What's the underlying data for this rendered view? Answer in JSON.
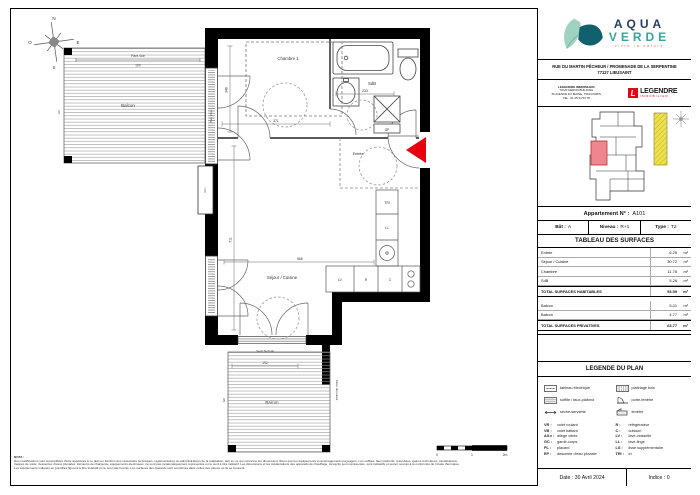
{
  "compass": {
    "n": "N",
    "s": "S",
    "e": "E",
    "o": "O"
  },
  "plan": {
    "arrow_color": "#e8000d",
    "rooms": {
      "chambre": "Chambre 1",
      "sdb": "SdB",
      "sejour": "Séjour / Cuisine",
      "entree": "Entrée",
      "balcon_haut": "Balcon",
      "balcon_bas": "Balcon"
    },
    "labels": {
      "pare_vue": "Pare-vue",
      "baie_vitree": "Baie vitrée",
      "allege": "All.v",
      "seuil": "Seuil Technal",
      "store": "Store déroulant",
      "gc_top": "GC",
      "gc_bottom": "GC",
      "gaine": "GP"
    },
    "kitchen": {
      "tri": "TRI",
      "ll": "LL",
      "lv": "LV",
      "r": "R",
      "c": "C"
    },
    "dims": {
      "d190": "190",
      "d348": "348",
      "d371": "371",
      "d233": "233",
      "d711": "711",
      "d566": "566",
      "d192": "192"
    }
  },
  "scalebar": {
    "t0": "0",
    "t1": "1",
    "t2": "2m"
  },
  "nota": {
    "title": "NOTA :",
    "line1": "Des modifications sont susceptibles d'être apportées à ce plan en fonction des nécessités techniques, réglementaires ou administratives de la réalisation, tant en ce qui concerne les dimensions libres que les équipements et aménagements paysagers. Les soffites, faux plafonds, retombées, gaines techniques, canalisations,",
    "line2": "trappes de visite, descentes d'eaux pluviales, éléments de charpente, équipements électriques, ne sont pas systématiquement représentés ou le sont à titre indicatif. Les dimensions et les implantations des appareils de chauffage, lorsqu'ils sont représentés, sont indicatifs et seront soumis à la conformité de l'étude thermique.",
    "line3": "Les équipements indiqués en pointillés figurent à titre indicatif et ne sont pas fournis. Les surfaces des placards sont comprises dans celles des pièces où ils se trouvent."
  },
  "titleblock": {
    "logo": {
      "word1": "AQUA",
      "word2": "VERDE",
      "tagline": "vivre la nature"
    },
    "address_line1": "RUE DU MARTIN PÊCHEUR / PROMENADE DE LA SERPENTINE",
    "address_line2": "77127 LIEUSAINT",
    "promoter": {
      "name": "LEGENDRE IMMOBILIER",
      "building": "TOUR HERON BUILDING",
      "street": "66 AVENUE DU MAINE, 75014 PARIS",
      "tel": "TEL : 01 45 54 53 78",
      "mark": "L",
      "brand": "LEGENDRE",
      "brand_sub": "IMMOBILIER",
      "brand_red": "#e30613"
    },
    "apartment": {
      "label": "Appartement N° :",
      "value": "A101"
    },
    "cells": {
      "bat_label": "Bât :",
      "bat": "A",
      "niveau_label": "Niveau :",
      "niveau": "R+1",
      "type_label": "Type :",
      "type": "T2"
    },
    "surfaces": {
      "title": "TABLEAU DES SURFACES",
      "unit": "m²",
      "rows": [
        {
          "label": "Entrée",
          "value": "6.25"
        },
        {
          "label": "Séjour / Cuisine",
          "value": "30.72"
        },
        {
          "label": "Chambre",
          "value": "11.76"
        },
        {
          "label": "SdB",
          "value": "5.26"
        }
      ],
      "total_hab": {
        "label": "TOTAL SURFACES HABITABLES",
        "value": "53.99"
      },
      "balcons": [
        {
          "label": "Balcon",
          "value": "5.01"
        },
        {
          "label": "Balcon",
          "value": "4.77"
        }
      ],
      "total_priv": {
        "label": "TOTAL SURFACES PRIVATIVES",
        "value": "63.77"
      }
    },
    "legend": {
      "title": "LEGENDE DU PLAN",
      "items": [
        {
          "icon": "tableau-electrique",
          "label": "tableau électrique"
        },
        {
          "icon": "platelage-bois",
          "label": "platelage bois"
        },
        {
          "icon": "soffite-faux-plafond",
          "label": "soffite / faux-plafond"
        },
        {
          "icon": "porte-fenetre",
          "label": "porte-fenêtre"
        },
        {
          "icon": "seche-serviette",
          "label": "sèche-serviette"
        },
        {
          "icon": "fenetre",
          "label": "fenêtre"
        }
      ],
      "abbr_left": [
        {
          "k": "VR :",
          "v": "volet roulant"
        },
        {
          "k": "VB :",
          "v": "volet battant"
        },
        {
          "k": "All.v :",
          "v": "allège vitrée"
        },
        {
          "k": "GC :",
          "v": "garde-corps"
        },
        {
          "k": "PL :",
          "v": "placard"
        },
        {
          "k": "EP :",
          "v": "descente d'eau pluviale"
        }
      ],
      "abbr_right": [
        {
          "k": "R :",
          "v": "réfrigérateur"
        },
        {
          "k": "C :",
          "v": "cuisson"
        },
        {
          "k": "LV :",
          "v": "lave-vaisselle"
        },
        {
          "k": "LL :",
          "v": "lave-linge"
        },
        {
          "k": "LS :",
          "v": "lisse supplémentaire"
        },
        {
          "k": "TRI :",
          "v": "tri"
        }
      ]
    },
    "footer": {
      "date": "Date : 30 Avril 2024",
      "indice": "Indice : 0"
    }
  }
}
